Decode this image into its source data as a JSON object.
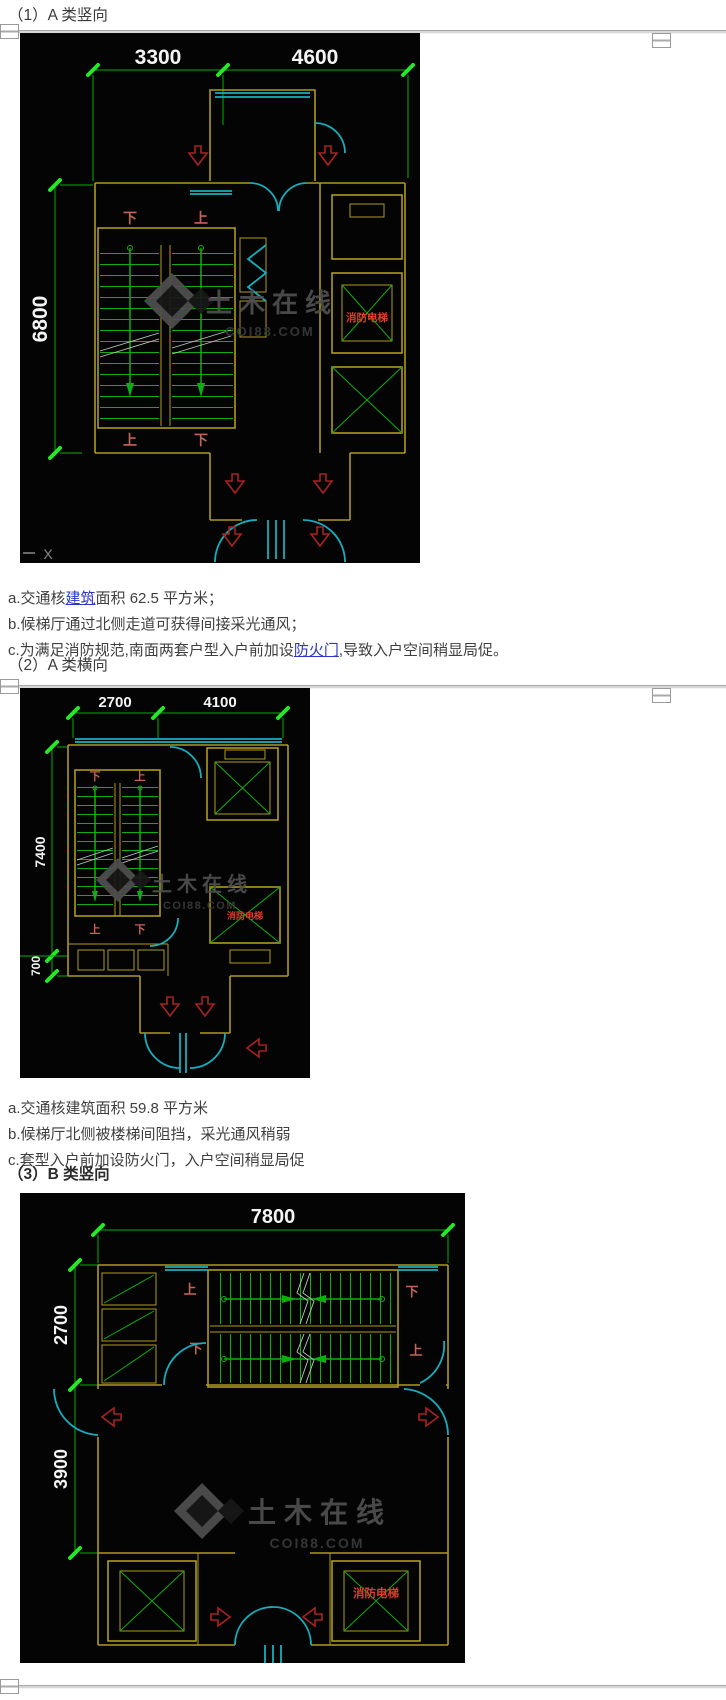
{
  "colors": {
    "title_text": "#3a3a3a",
    "body_text": "#3f3f3f",
    "link": "#2a35c9",
    "cad_bg": "#040404",
    "wall_yellow": "#ad9a1e",
    "dim_green": "#00b000",
    "tick_green": "#27e827",
    "stair_green": "#0fae0f",
    "door_cyan": "#17aebc",
    "label_red": "#c26358",
    "fire_red": "#e03c2c",
    "arrow_red": "#a82222",
    "dim_white": "#f4f4f4",
    "break_gray": "#b9c9b9",
    "wm_gray": "#4f4f4f",
    "wm_dark": "#3a3a3a"
  },
  "watermark": {
    "cn": "土木在线",
    "url": "COI88.COM"
  },
  "sections": [
    {
      "title": "（1）A 类竖向",
      "drawing": {
        "dims_top": [
          "3300",
          "4600"
        ],
        "dims_left": [
          "6800"
        ],
        "stairs_top": [
          "下",
          "上"
        ],
        "stairs_bottom": [
          "上",
          "下"
        ],
        "fire_elevator": "消防电梯",
        "axis": "X"
      },
      "notes": {
        "a_pre": "a.交通核",
        "a_link": "建筑",
        "a_post": "面积 62.5 平方米；",
        "b": "b.候梯厅通过北侧走道可获得间接采光通风；",
        "c_pre": "c.为满足消防规范,南面两套户型入户前加设",
        "c_link": "防火门",
        "c_post": ",导致入户空间稍显局促。"
      }
    },
    {
      "title": "（2）A 类横向",
      "drawing": {
        "dims_top": [
          "2700",
          "4100"
        ],
        "dims_left": [
          "7400",
          "700"
        ],
        "stairs_top": [
          "下",
          "上"
        ],
        "stairs_bottom": [
          "上",
          "下"
        ],
        "fire_elevator": "消防电梯"
      },
      "notes": {
        "a": "a.交通核建筑面积 59.8 平方米",
        "b": "b.候梯厅北侧被楼梯间阻挡，采光通风稍弱",
        "c": "c.套型入户前加设防火门，入户空间稍显局促"
      }
    },
    {
      "title": "（3）B 类竖向",
      "drawing": {
        "dims_top": [
          "7800"
        ],
        "dims_left": [
          "2700",
          "3900"
        ],
        "stairs_row1": [
          "上",
          "下"
        ],
        "stairs_row2": [
          "下",
          "上"
        ],
        "fire_elevator": "消防电梯"
      }
    }
  ]
}
